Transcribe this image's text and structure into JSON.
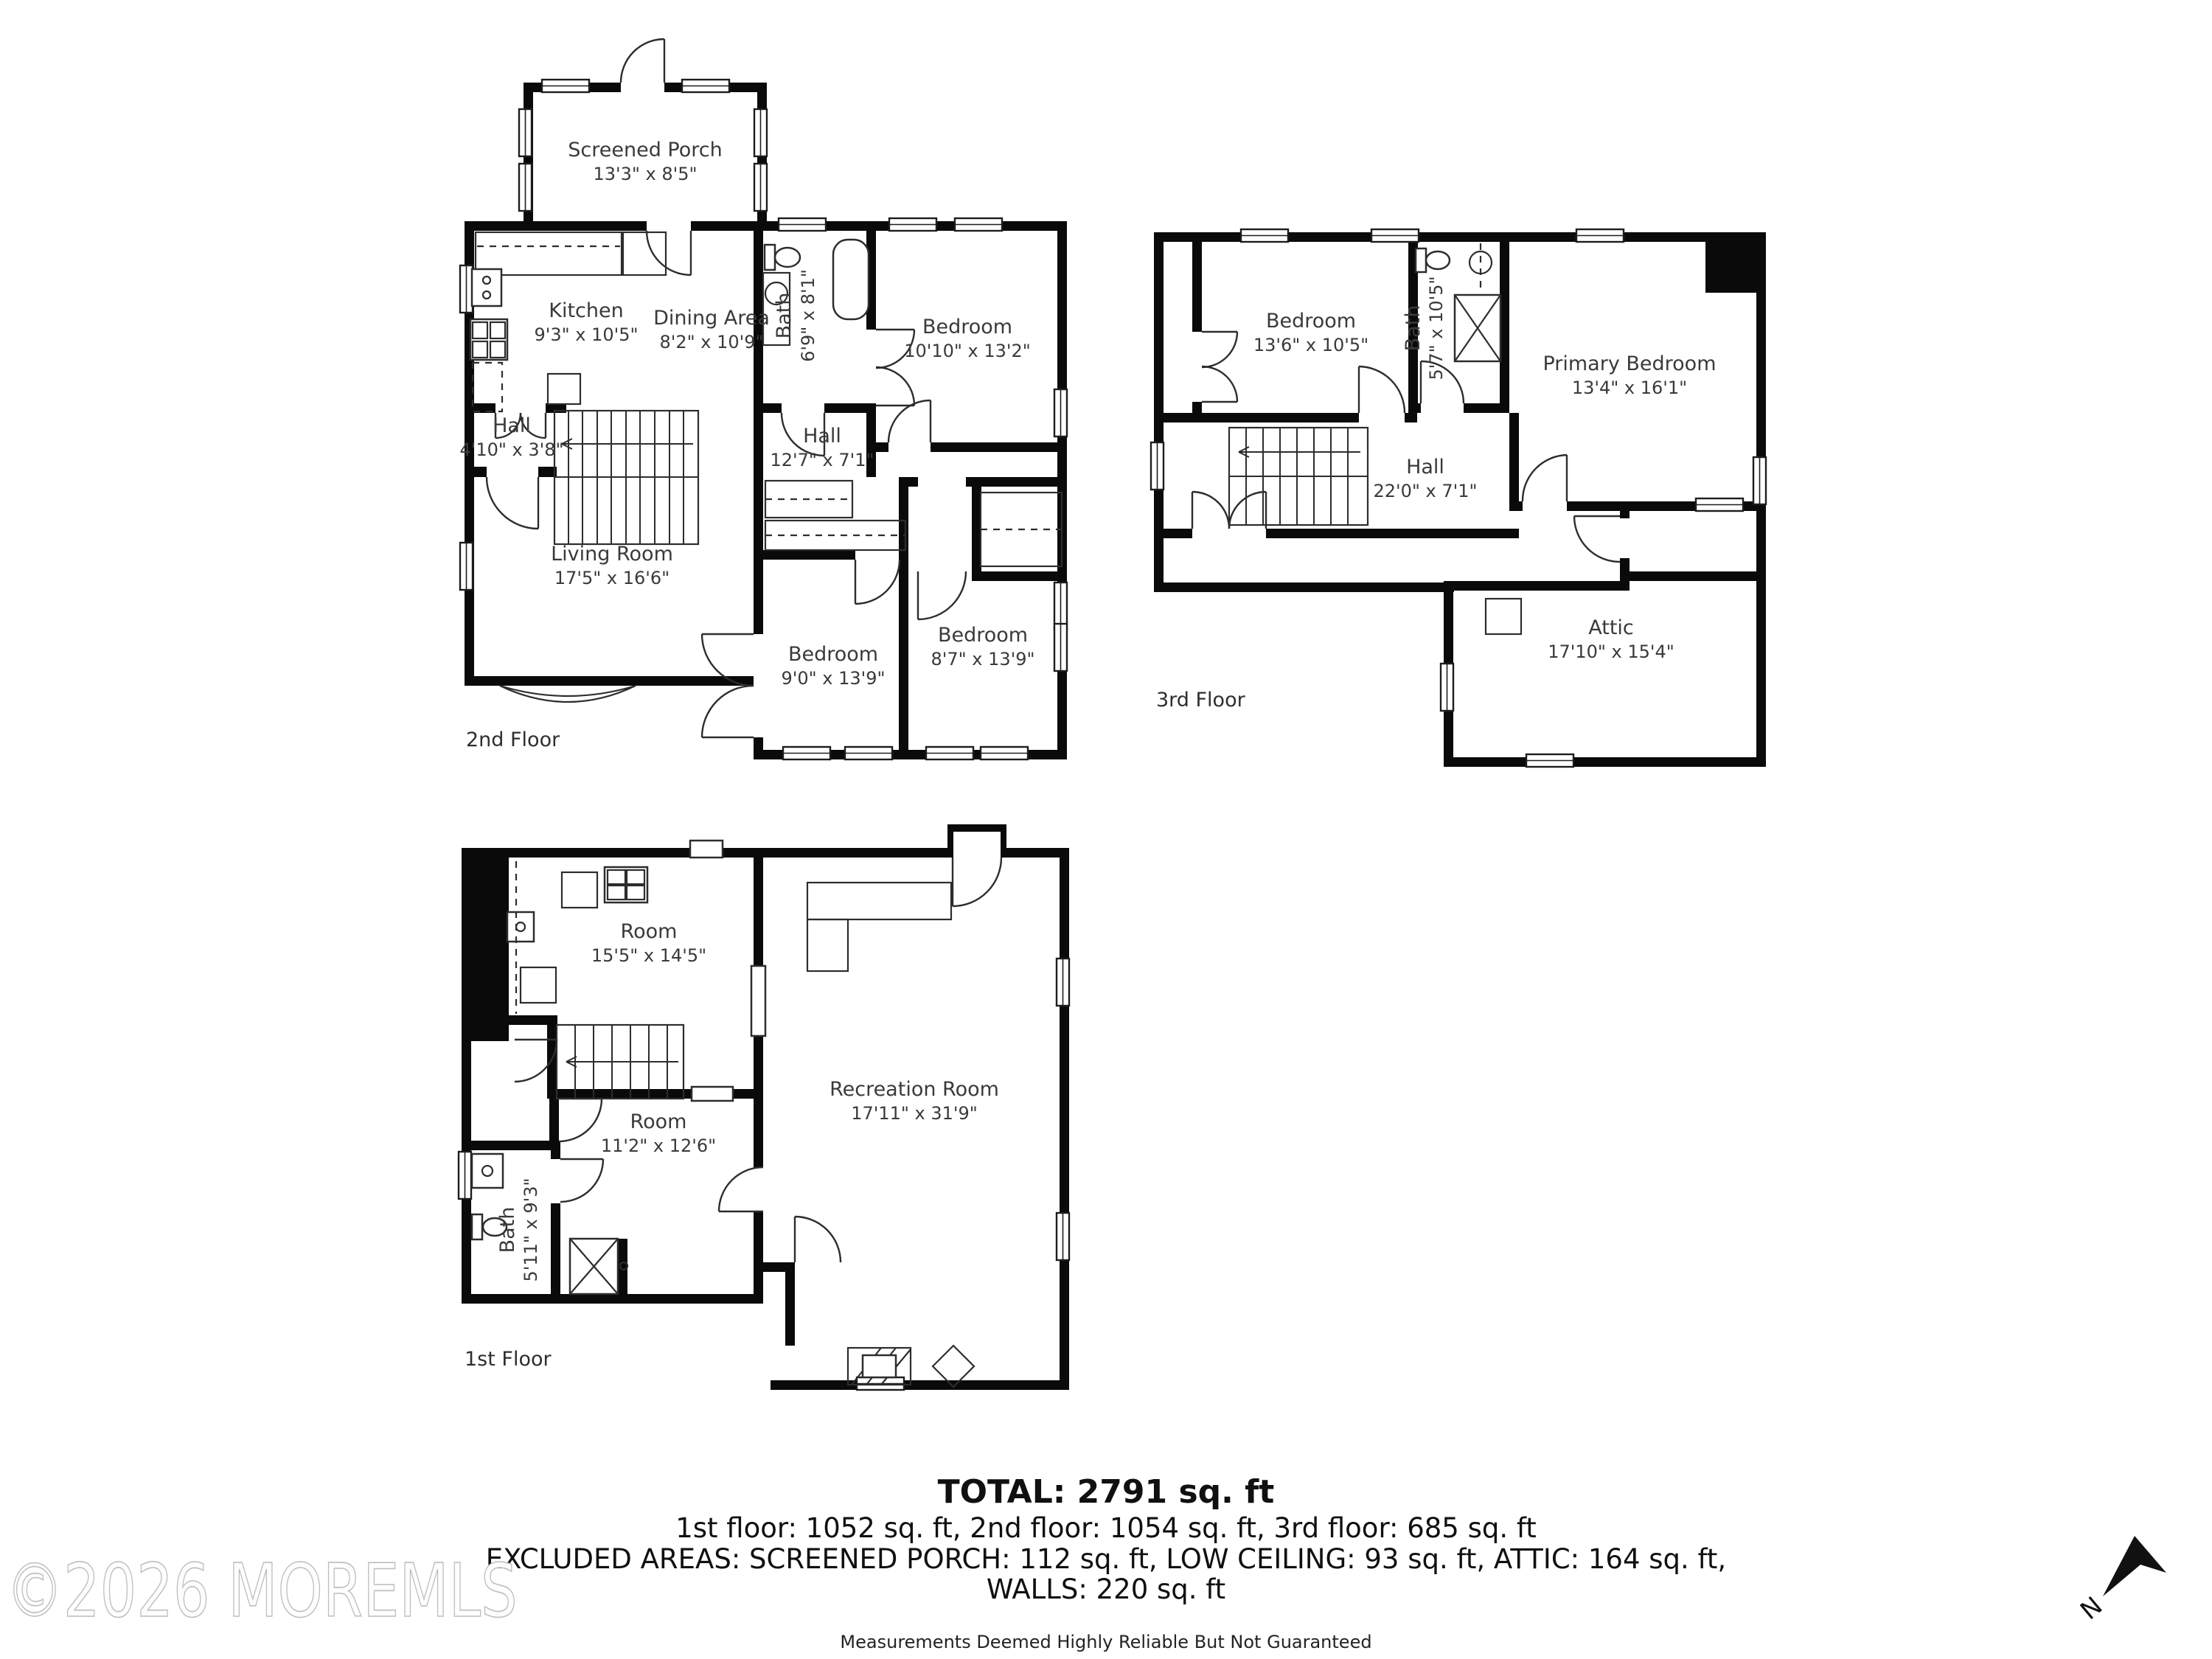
{
  "floors": {
    "second": {
      "label": "2nd Floor",
      "rooms": {
        "screened_porch": {
          "name": "Screened Porch",
          "dims": "13'3\" x 8'5\""
        },
        "kitchen": {
          "name": "Kitchen",
          "dims": "9'3\" x 10'5\""
        },
        "dining": {
          "name": "Dining Area",
          "dims": "8'2\" x 10'9\""
        },
        "bath": {
          "name": "Bath",
          "dims": "6'9\" x 8'1\""
        },
        "bedroom_top": {
          "name": "Bedroom",
          "dims": "10'10\" x 13'2\""
        },
        "hall_small": {
          "name": "Hall",
          "dims": "4'10\" x 3'8\""
        },
        "hall": {
          "name": "Hall",
          "dims": "12'7\" x 7'1\""
        },
        "living": {
          "name": "Living Room",
          "dims": "17'5\" x 16'6\""
        },
        "bedroom_left": {
          "name": "Bedroom",
          "dims": "9'0\" x 13'9\""
        },
        "bedroom_right": {
          "name": "Bedroom",
          "dims": "8'7\" x 13'9\""
        }
      }
    },
    "third": {
      "label": "3rd Floor",
      "rooms": {
        "bedroom": {
          "name": "Bedroom",
          "dims": "13'6\" x 10'5\""
        },
        "bath": {
          "name": "Bath",
          "dims": "5'7\" x 10'5\""
        },
        "primary": {
          "name": "Primary Bedroom",
          "dims": "13'4\" x 16'1\""
        },
        "hall": {
          "name": "Hall",
          "dims": "22'0\" x 7'1\""
        },
        "attic": {
          "name": "Attic",
          "dims": "17'10\" x 15'4\""
        }
      }
    },
    "first": {
      "label": "1st Floor",
      "rooms": {
        "room_upper": {
          "name": "Room",
          "dims": "15'5\" x 14'5\""
        },
        "recreation": {
          "name": "Recreation Room",
          "dims": "17'11\" x 31'9\""
        },
        "room_lower": {
          "name": "Room",
          "dims": "11'2\" x 12'6\""
        },
        "bath": {
          "name": "Bath",
          "dims": "5'11\" x 9'3\""
        }
      }
    }
  },
  "summary": {
    "total": "TOTAL: 2791 sq. ft",
    "floors_line": "1st floor: 1052 sq. ft, 2nd floor: 1054 sq. ft, 3rd floor: 685 sq. ft",
    "excluded_line": "EXCLUDED AREAS: SCREENED PORCH: 112 sq. ft, LOW CEILING: 93 sq. ft, ATTIC: 164 sq. ft,",
    "walls_line": "WALLS: 220 sq. ft",
    "disclaimer": "Measurements Deemed Highly Reliable But Not Guaranteed"
  },
  "watermark": "©2026 MOREMLS",
  "compass": {
    "north_label": "N"
  },
  "colors": {
    "wall": "#000000",
    "background": "#ffffff",
    "label_text": "#3a3a3a"
  }
}
